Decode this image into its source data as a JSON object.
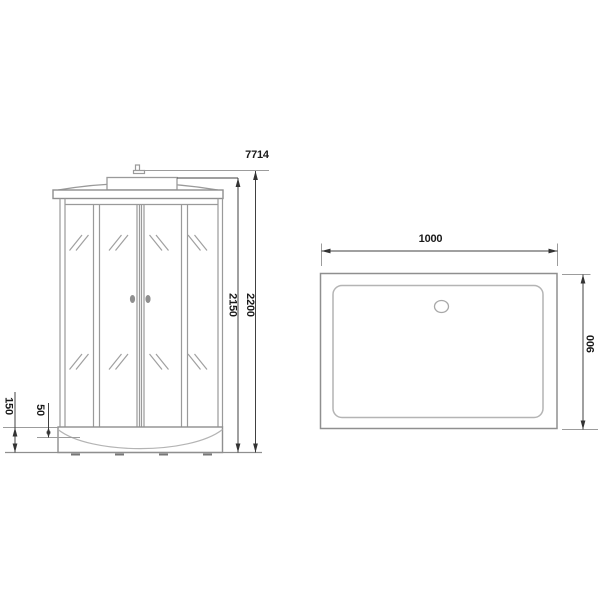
{
  "drawing": {
    "model_number": "7714",
    "front_view": {
      "dimensions": {
        "cabin_height": "2150",
        "total_height": "2200",
        "tray_height": "150",
        "tray_rim_height": "50"
      }
    },
    "top_view": {
      "dimensions": {
        "width": "1000",
        "depth": "900"
      }
    },
    "colors": {
      "background": "#ffffff",
      "product_outline": "#8f8f8f",
      "product_line": "#9a9a9a",
      "product_line_light": "#b4b4b4",
      "dimension_line": "#404040",
      "extension_line": "#9c9c9c",
      "label_text": "#1a1a1a",
      "handle_fill": "#8f8f8f"
    }
  }
}
